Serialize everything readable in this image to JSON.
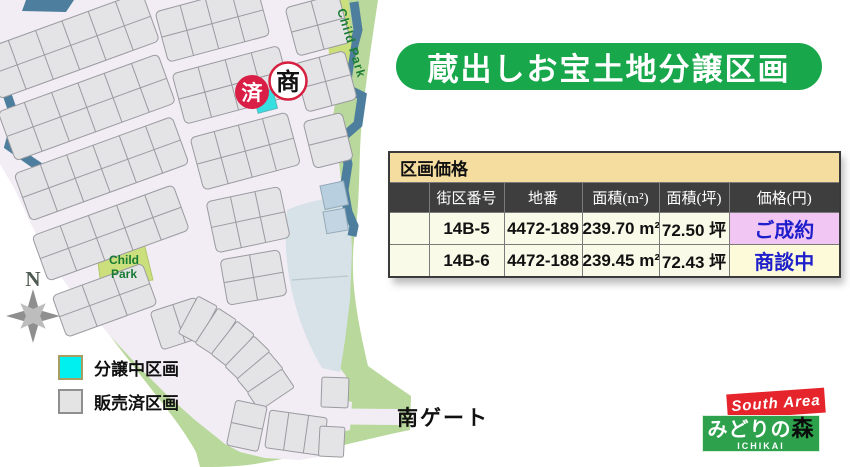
{
  "banner": {
    "title": "蔵出しお宝土地分譲区画",
    "bg": "#18a74b"
  },
  "map": {
    "compass_label": "N",
    "child_park_top": "Child Park",
    "child_park_line1": "Child",
    "child_park_line2": "Park",
    "south_gate_label": "南ゲート",
    "badge_sold": "済",
    "badge_negotiating": "商",
    "legend": [
      {
        "label": "分譲中区画",
        "color": "#00efef"
      },
      {
        "label": "販売済区画",
        "color": "#e4e4e4"
      }
    ]
  },
  "price_table": {
    "title": "区画価格",
    "columns": [
      "街区番号",
      "地番",
      "面積(m²)",
      "面積(坪)",
      "価格(円)"
    ],
    "rows": [
      {
        "block_no": "14B-5",
        "lot_no": "4472-189",
        "area_m2": "239.70 m²",
        "area_tsubo": "72.50 坪",
        "status": "ご成約",
        "status_bg": "#f1c6f3",
        "status_color": "#1e1ecb"
      },
      {
        "block_no": "14B-6",
        "lot_no": "4472-188",
        "area_m2": "239.45 m²",
        "area_tsubo": "72.43 坪",
        "status": "商談中",
        "status_bg": "#fcfad8",
        "status_color": "#1e1ecb"
      }
    ]
  },
  "logo": {
    "area_label": "South Area",
    "name_main": "みどりの",
    "name_accent": "森",
    "subtitle": "ICHIKAI",
    "red": "#e6242b",
    "green": "#2da14b"
  }
}
